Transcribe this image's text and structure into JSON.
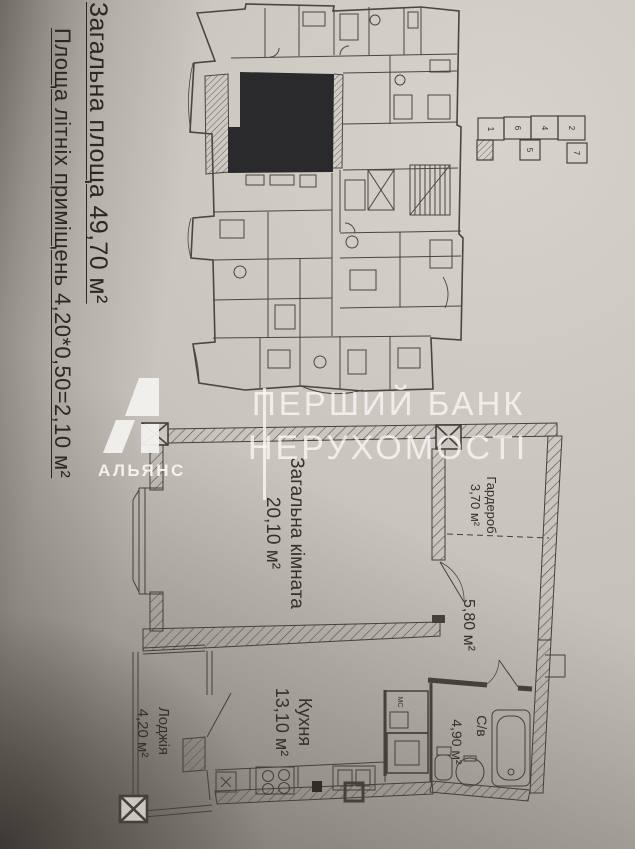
{
  "notes": {
    "total_area": "Загальна площа 49,70 м²",
    "summer_area": "Площа літніх приміщень 4,20*0,50=2,10 м²"
  },
  "watermark": {
    "line1": "ПЕРШИЙ БАНК",
    "line2": "НЕРУХОМОСТІ",
    "brand_name": "АЛЬЯНС"
  },
  "apartment_plan": {
    "rooms": {
      "living": {
        "name": "Загальна кімната",
        "area": "20,10 м²"
      },
      "wardrobe": {
        "name": "Гардероб",
        "area": "3,70 м²"
      },
      "hallway": {
        "area": "5,80 м²"
      },
      "kitchen": {
        "name": "Кухня",
        "area": "13,10 м²"
      },
      "bathroom": {
        "name": "С/в",
        "area": "4,90 м²"
      },
      "loggia": {
        "name": "Лоджія",
        "area": "4,20 м²"
      }
    },
    "shaft_label": "МС"
  },
  "key_plan": {
    "sections": [
      "1",
      "6",
      "4",
      "2",
      "5",
      "7"
    ]
  },
  "colors": {
    "paper": "#cac6be",
    "ink": "#46423c",
    "highlighted_unit": "#2a2a2c",
    "watermark": "#faf9f6"
  }
}
